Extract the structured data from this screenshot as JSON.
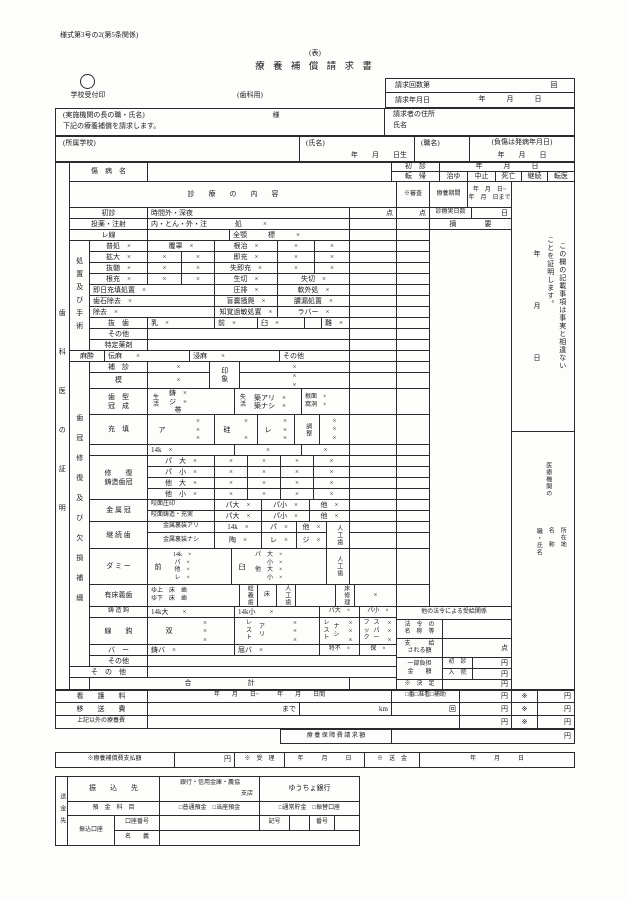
{
  "header": {
    "style_no": "様式第3号の2(第5条関係)",
    "omote": "(表)",
    "title": "療 養 補 償 請 求 書",
    "dental": "(歯科用)",
    "stamp_label": "学校受付印"
  },
  "claim": {
    "times": "請求回数第",
    "times_unit": "回",
    "date_label": "請求年月日",
    "ymd": "年　　　月　　　日"
  },
  "request": {
    "to": "(実施機関の長の職・氏名)",
    "sama": "様",
    "body": "下記の療養補償を請求します。",
    "addr": "請求者の住所",
    "name": "氏名"
  },
  "who": {
    "school": "(所属学校)",
    "name": "(氏名)",
    "born": "年　　月　　日生",
    "job": "(職名)",
    "injury": "(負傷は発病年月日)",
    "ymd": "年　　月　　日"
  },
  "byomei": {
    "label": "傷　病　名",
    "first": "初　診",
    "first_ymd": "年　　　月　　　日",
    "tenki": "転　帰",
    "o1": "治ゆ",
    "o2": "中止",
    "o3": "死亡",
    "o4": "継続",
    "o5": "転医"
  },
  "head": {
    "naiyo": "診　　療　　の　　内　　容",
    "shinsa": "※審査",
    "kikan": "療養期間",
    "k12": "年　月　日~\n年　月　日まで",
    "days": "診療実日数",
    "day": "日",
    "ten": "点",
    "tekiyo": "摘　　　　要"
  },
  "certify": {
    "left": "歯科医の証明",
    "line1": "この欄の記載事項は事実と相違ない",
    "line2": "ことを証明します。",
    "y": "年",
    "m": "月",
    "d": "日",
    "org": "医療機関の",
    "addr": "所在地",
    "name": "名　称",
    "job": "職・氏名"
  },
  "grp": {
    "shochi": "処置及び手術",
    "shikan": "歯冠修復及び欠損補綴",
    "masui": "麻酔"
  },
  "rows": {
    "shoshin": [
      "初診",
      "時間外・深夜"
    ],
    "toyaku": [
      "投薬・注射",
      "内・とん・外・注　　　　処　　　×"
    ],
    "xray": [
      "レ線",
      "全顎　　　標　　　×"
    ],
    "s1": [
      "普処　×",
      "覆罩　×",
      "根治　×",
      "×",
      "×"
    ],
    "s2": [
      "拡大　×",
      "×",
      "×",
      "即充　×",
      "×",
      "×"
    ],
    "s3": [
      "抜髄　×",
      "×",
      "×",
      "失即充　×",
      "×",
      "×"
    ],
    "s4": [
      "根充　×",
      "×",
      "×",
      "生切　×",
      "失切　×"
    ],
    "s5": [
      "即日充填処置　×",
      "圧排　×",
      "軟外処　×"
    ],
    "s6": [
      "歯石除去　×",
      "盲嚢掻爬　×",
      "膿漏処置　×"
    ],
    "s7": [
      "除去　×",
      "知覚過敏処置　×",
      "ラバー　×"
    ],
    "s8": [
      "抜　歯",
      "乳　×",
      "前　×",
      "臼　×",
      "難　×"
    ],
    "s9": "その他",
    "s10": "特定薬剤",
    "masui": [
      "伝麻　　×",
      "浸麻　　×",
      "その他"
    ],
    "hoshin": [
      "補　診",
      "×"
    ],
    "insho": "印象",
    "insho_x": [
      "×",
      "×\n×"
    ],
    "mo": [
      "模",
      "×"
    ],
    "shikei_label": "歯　型\n冠　成",
    "shikei": [
      "生\n活",
      "鋳　×\nジ　×\n帯",
      "失\n活",
      "築アリ　×\n築ナシ　×",
      "根面　×\n窩洞　×"
    ],
    "juten_label": "充　填",
    "juten": [
      "ア",
      "×\n×\n×",
      "硅",
      "×\n\n×",
      "レ",
      "×\n×\n×",
      "調整",
      "×\n×\n×"
    ],
    "k14": [
      "14k　×",
      "×",
      "×"
    ],
    "shufuku_label": "修　　復\n鋳造歯冠",
    "f1": [
      "パ　大　×",
      "×",
      "×",
      "×",
      "×"
    ],
    "f2": [
      "パ　小　×",
      "×",
      "×",
      "×",
      "×"
    ],
    "f3": [
      "他　大　×",
      "×",
      "×",
      "×",
      "×"
    ],
    "f4": [
      "他　小　×",
      "×",
      "×",
      "×",
      "×"
    ],
    "kin_label": "金 属 冠",
    "kin1": [
      "咬面圧印",
      "パ大　×",
      "パ小　×",
      "他　×"
    ],
    "kin2": [
      "咬面鋳造・充実",
      "パ大　×",
      "パ小　×",
      "他　×"
    ],
    "kei_label": "継 続 歯",
    "kei1": [
      "金属裏装アリ",
      "14k　×",
      "パ　×",
      "他　×"
    ],
    "kei2": [
      "金属裏装ナシ",
      "陶　×",
      "レ　×",
      "ジ　×"
    ],
    "jinko": "人工歯",
    "dmy_label": "ダ ミ ー",
    "dmy1": "前",
    "dmy1_items": "14k　×\nパ　×\n他　×\nレ　×",
    "dmy2": "臼",
    "dmy2_items": "パ　大　×\n　　小　×\n他　大　×\n　　小　×",
    "yusho_label": "有床義歯",
    "yusho1": "ゆ上　床　歯\nゆ下　床　歯",
    "sogigishi": "総義歯",
    "toko": "床",
    "yuka_shuri": "床修理",
    "yusho_x": "×",
    "chuzo": [
      "鋳 造 鈎",
      "14k大　　×",
      "14k小　　×",
      "パ大　×",
      "パ小　×"
    ],
    "sen_label": "線　　鈎",
    "sen1": "双",
    "sen1x": "×\n×\n×",
    "sen2": "レ\nス\nト",
    "sen2b": "ア\nリ",
    "sen2x": "×\n×\n×",
    "sen3b": "ナ\nシ",
    "sen4a": "フ\nッ\nク",
    "sen4b": "ス\nパ\nー",
    "sen4x": "×\n×\n×",
    "bar": [
      "バ　ー",
      "鋳バ　×",
      "屈バ　×",
      "特不　×",
      "保　×"
    ],
    "sonota_in": "その他",
    "sonota_out": "そ　の　他",
    "gokei": "合　　　　　　　　計"
  },
  "hoka": {
    "title": "他の法令による受給関係",
    "horei": "法　令　の\n名　称　等",
    "shikyu": "支　　　給\nされる額",
    "ten": "点",
    "ichibu": "一部負担\n金　　額",
    "shoshin": "初　診",
    "nyuin": "入　院",
    "yen": "円",
    "kettei": "※　決　定"
  },
  "kango": {
    "label": "看　　護　　料",
    "dates": "年　　月　　日~　　　年　　月　　日間",
    "kind": "□番□准看□補助",
    "yen": "円",
    "star": "※"
  },
  "iso": {
    "label": "移　　送　　費",
    "made": "まで",
    "km": "km",
    "kai": "回",
    "yen": "円",
    "star": "※"
  },
  "jokigai": {
    "label": "上記以外の療養費",
    "yen": "円",
    "star": "※"
  },
  "seikyu": {
    "label": "療 養 保 障 費 請 求 額",
    "yen": "円"
  },
  "pay": {
    "label": "※療養補償費支払額",
    "yen": "円",
    "juri": "※　受　理",
    "ymd": "年　　　月　　　日",
    "sokin": "※　送　金"
  },
  "bank": {
    "label": "送金先",
    "furikomi": "振　　込　　先",
    "bank_line": "銀行・信用金庫・農協",
    "branch": "支店",
    "yucho": "ゆうちょ銀行",
    "yokin": "預　金　科　目",
    "futsu": "□普通預金　□当座預金",
    "tsujo": "□通常貯金　□振替口座",
    "koza": "振込口座",
    "koza_no": "口座番号",
    "kigo": "記号",
    "bango": "番号",
    "meigi": "名　　義"
  }
}
